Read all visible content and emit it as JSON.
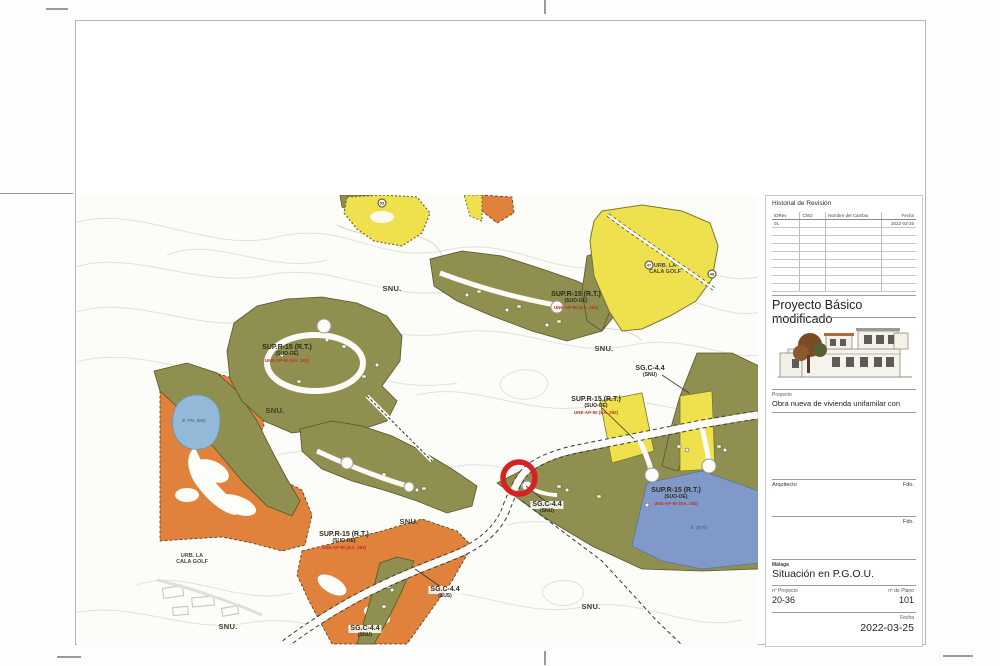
{
  "sheet": {
    "map": {
      "labels": [
        {
          "type": "area",
          "text": "SNU.",
          "x": 315,
          "y": 90
        },
        {
          "type": "area",
          "text": "SNU.",
          "x": 198,
          "y": 212
        },
        {
          "type": "area",
          "text": "SNU.",
          "x": 527,
          "y": 150
        },
        {
          "type": "area",
          "text": "SNU.",
          "x": 332,
          "y": 323
        },
        {
          "type": "area",
          "text": "SNU.",
          "x": 151,
          "y": 428
        },
        {
          "type": "area",
          "text": "SNU.",
          "x": 514,
          "y": 408
        },
        {
          "type": "zone",
          "text": "SUP.R-15 (R.T.)",
          "sub": "(SUO-OE)",
          "red": "UNE-AP-90 (EA. 292)",
          "x": 499,
          "y": 96
        },
        {
          "type": "zone",
          "text": "SUP.R-15 (R.T.)",
          "sub": "(SUO-OE)",
          "red": "UNE-AP-90 (EA. 292)",
          "x": 210,
          "y": 149
        },
        {
          "type": "zone",
          "text": "SUP.R-15 (R.T.)",
          "sub": "(SUO-OE)",
          "red": "UNE-AP-90 (EA. 292)",
          "x": 519,
          "y": 201
        },
        {
          "type": "zone",
          "text": "SUP.R-15 (R.T.)",
          "sub": "(SUO-OE)",
          "red": "UNE-AP-90 (EA. 292)",
          "x": 599,
          "y": 292
        },
        {
          "type": "zone",
          "text": "SUP.R-15 (R.T.)",
          "sub": "(SUO-OE)",
          "red": "UNE-AP-90 (EA. 292)",
          "x": 267,
          "y": 336
        },
        {
          "type": "urb",
          "text": "URB. LA",
          "sub": "CALA GOLF",
          "x": 588,
          "y": 68
        },
        {
          "type": "urb",
          "text": "URB. LA",
          "sub": "CALA GOLF",
          "x": 115,
          "y": 358
        },
        {
          "type": "sg",
          "text": "SG.C-4.4",
          "sub": "(SNU)",
          "x": 573,
          "y": 170
        },
        {
          "type": "sg",
          "text": "SG.C-4.4",
          "sub": "(SNU)",
          "x": 470,
          "y": 306
        },
        {
          "type": "sg",
          "text": "SG.C-4.4",
          "sub": "(SUS)",
          "x": 368,
          "y": 391
        },
        {
          "type": "sg",
          "text": "SG.C-4.4",
          "sub": "(SNU)",
          "x": 288,
          "y": 430
        },
        {
          "type": "tiny",
          "text": "E. PN. (EB)",
          "x": 117,
          "y": 223
        },
        {
          "type": "tiny",
          "text": "E. (E75)",
          "x": 622,
          "y": 330
        }
      ],
      "markers": [
        {
          "text": "53",
          "x": 305,
          "y": 8
        },
        {
          "text": "47",
          "x": 572,
          "y": 70
        },
        {
          "text": "48",
          "x": 635,
          "y": 79
        }
      ]
    },
    "title_block": {
      "revision_title": "Historial de Revisión",
      "revision_headers": [
        "IDRev",
        "ChID",
        "Nombre del Cambio",
        "Fecha"
      ],
      "revision_rows": [
        [
          "01",
          "",
          "",
          "2022-03-25"
        ]
      ],
      "phase_title": "Proyecto Básico modificado",
      "proyecto_label": "Proyecto",
      "proyecto_value": "Obra nueva de vivienda unifamilar con",
      "arquitecto_label": "Arquitecto",
      "firma_label_1": "Fdo.",
      "firma_label_2": "Fdo.",
      "city": "Málaga",
      "plan_title": "Situación en P.G.O.U.",
      "num_proyecto_label": "nº Proyecto",
      "num_proyecto_value": "20-36",
      "num_plano_label": "nº de Plano",
      "num_plano_value": "101",
      "fecha_label": "Fecha",
      "fecha_value": "2022-03-25"
    },
    "colors": {
      "orange_zone": "#e0813c",
      "olive_zone": "#8f8f50",
      "yellow_zone": "#efe14e",
      "blue_parcel": "#8099c9",
      "pond": "#92b9d8",
      "marker_ring_red": "#d62222"
    }
  }
}
